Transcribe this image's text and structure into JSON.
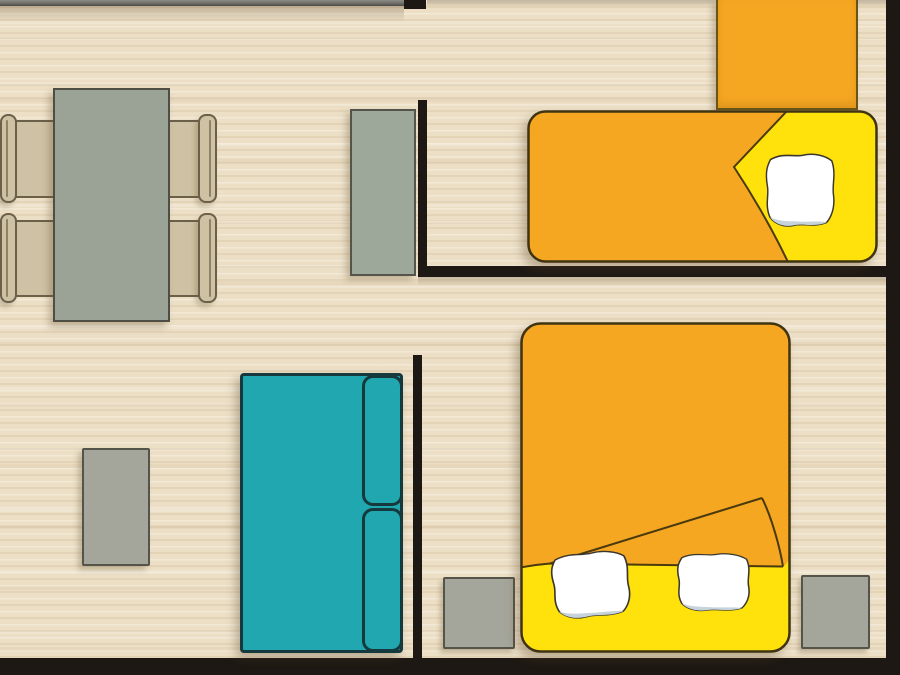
{
  "scene": {
    "type": "apartment floor plan, top-down view",
    "canvas_px": {
      "width": 900,
      "height": 675
    }
  },
  "palette": {
    "floor-base": "#ECDFC6",
    "wall-black": "#1D1813",
    "wall-gray": "#706E69",
    "table-gray": "#9AA396",
    "chair-tan": "#CFC1A3",
    "chair-outline": "#6B604A",
    "cabinet-gray": "#9DA79A",
    "nightstand-gray": "#A5A69B",
    "coffee-table-gray": "#A4A59B",
    "sofa-teal": "#21A7AF",
    "sofa-outline": "#16393D",
    "bed-orange": "#F6A722",
    "bed-yellow": "#FFE10C",
    "bed-outline": "#3F3310",
    "bed-crease": "#4A3A0E",
    "pillow-white": "#FFFFFF",
    "pillow-shade": "#C7D3DA",
    "furniture-outline": "#55544A"
  },
  "rooms": [
    {
      "id": "living-dining",
      "label": "Living and dining area",
      "position": "left"
    },
    {
      "id": "bedroom-single",
      "label": "Bedroom with single bed",
      "position": "top-right"
    },
    {
      "id": "bedroom-double",
      "label": "Bedroom with double bed",
      "position": "bottom-right"
    }
  ],
  "furniture": [
    {
      "id": "dining-table",
      "label": "Dining table",
      "room": "living-dining",
      "color": "table-gray"
    },
    {
      "id": "dining-chairs",
      "label": "Dining chair",
      "count": 4,
      "room": "living-dining",
      "color": "chair-tan"
    },
    {
      "id": "sideboard",
      "label": "Sideboard cabinet",
      "room": "living-dining",
      "color": "cabinet-gray"
    },
    {
      "id": "coffee-table",
      "label": "Coffee table",
      "room": "living-dining",
      "color": "coffee-table-gray"
    },
    {
      "id": "sofa",
      "label": "Sofa with two back cushions",
      "room": "living-dining",
      "color": "sofa-teal"
    },
    {
      "id": "wardrobe",
      "label": "Wardrobe",
      "room": "bedroom-single",
      "color": "bed-orange"
    },
    {
      "id": "single-bed",
      "label": "Single bed with orange blanket, folded corner and one pillow",
      "room": "bedroom-single",
      "pillows": 1,
      "colors": [
        "bed-orange",
        "bed-yellow",
        "pillow-white"
      ]
    },
    {
      "id": "double-bed",
      "label": "Double bed with orange blanket, folded corner and two pillows",
      "room": "bedroom-double",
      "pillows": 2,
      "colors": [
        "bed-orange",
        "bed-yellow",
        "pillow-white"
      ]
    },
    {
      "id": "nightstand-left",
      "label": "Nightstand",
      "room": "bedroom-double",
      "color": "nightstand-gray"
    },
    {
      "id": "nightstand-right",
      "label": "Nightstand",
      "room": "bedroom-double",
      "color": "nightstand-gray"
    }
  ]
}
